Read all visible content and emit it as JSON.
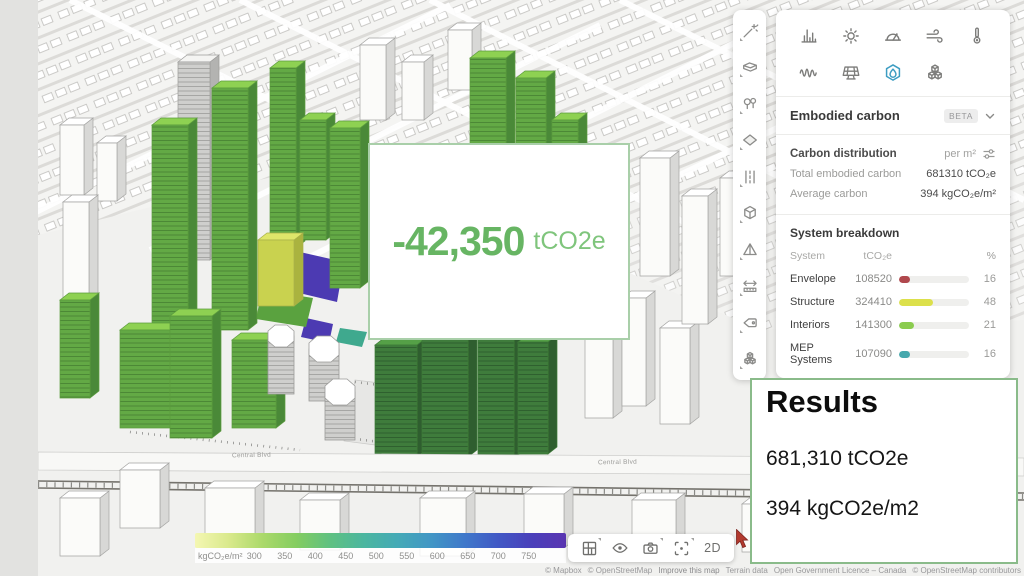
{
  "edit_toolbar": {
    "tools": [
      "magic-wand",
      "volume-box",
      "vegetation",
      "surface",
      "roads",
      "box-3d",
      "prism",
      "measure",
      "label-tag",
      "asset-cubes"
    ]
  },
  "analysis_panel": {
    "tools_row1": [
      "statistics",
      "sun-hours",
      "daylight",
      "wind",
      "temperature"
    ],
    "tools_row2": [
      "noise",
      "solar-panel",
      "embodied-carbon",
      "materials"
    ],
    "selected_tool": "embodied-carbon",
    "section": {
      "title": "Embodied carbon",
      "badge": "BETA"
    },
    "distribution": {
      "label": "Carbon distribution",
      "unit": "per m²",
      "total_label": "Total embodied carbon",
      "total_value": "681310 tCO₂e",
      "average_label": "Average carbon",
      "average_value": "394 kgCO₂e/m²"
    },
    "breakdown": {
      "title": "System breakdown",
      "columns": {
        "system": "System",
        "tco2e": "tCO₂e",
        "percent": "%"
      },
      "rows": [
        {
          "system": "Envelope",
          "value": "108520",
          "pct": 16,
          "color": "#b0484d"
        },
        {
          "system": "Structure",
          "value": "324410",
          "pct": 48,
          "color": "#dce04b"
        },
        {
          "system": "Interiors",
          "value": "141300",
          "pct": 21,
          "color": "#8bcc4f"
        },
        {
          "system": "MEP Systems",
          "value": "107090",
          "pct": 16,
          "color": "#46a8ad"
        }
      ]
    }
  },
  "callout": {
    "value": "-42,350",
    "unit": "tCO2e"
  },
  "results": {
    "title": "Results",
    "line1": "681,310 tCO2e",
    "line2": "394 kgCO2e/m2"
  },
  "legend": {
    "unit": "kgCO₂e/m²",
    "ticks": [
      "300",
      "350",
      "400",
      "450",
      "500",
      "550",
      "600",
      "650",
      "700",
      "750"
    ],
    "gradient": [
      "#f4f7b2",
      "#d9e98c",
      "#abd96a",
      "#84cd60",
      "#5fc181",
      "#4bb69f",
      "#44aab6",
      "#4196c5",
      "#3f78ca",
      "#4158c5",
      "#4a3fba",
      "#5a35b1"
    ]
  },
  "viewport_toolbar": {
    "buttons": [
      "layout-grid",
      "visibility",
      "camera",
      "focus"
    ],
    "mode": "2D"
  },
  "map": {
    "road_labels": [
      "Central Blvd",
      "Central Blvd",
      "Central Blvd"
    ],
    "attribution": [
      "© Mapbox",
      "© OpenStreetMap",
      "Improve this map",
      "Terrain data",
      "Open Government Licence – Canada",
      "© OpenStreetMap contributors"
    ]
  },
  "colors": {
    "accent_green": "#67b563",
    "selected_tool_blue": "#3d9dc2"
  }
}
